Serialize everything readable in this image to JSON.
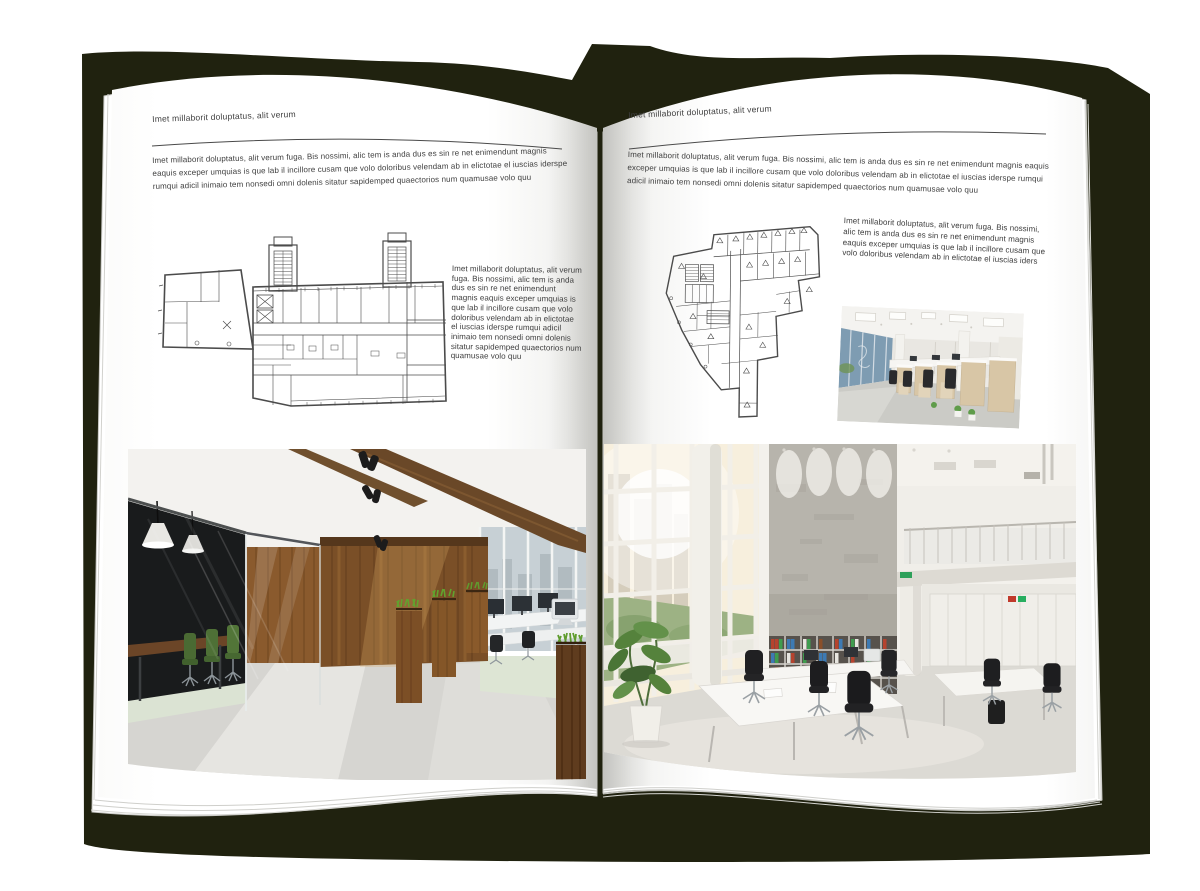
{
  "book": {
    "left_page": {
      "header": "Imet millaborit doluptatus, alit verum",
      "intro": "Imet millaborit doluptatus, alit verum fuga. Bis nossimi, alic tem is anda dus es sin re net enimendunt magnis eaquis exceper umquias is que lab il incillore cusam que volo doloribus velendam ab in elictotae el iuscias iderspe rumqui adicil inimaio tem nonsedi omni dolenis sitatur sapidemped quaectorios num quamusae volo quu",
      "side_text": "Imet millaborit doluptatus, alit verum fuga. Bis nossimi, alic tem is anda dus es sin re net enimendunt magnis eaquis exceper umquias is que lab il incillore cusam que volo doloribus velendam ab in elictotae el iuscias iderspe rumqui adicil inimaio tem nonsedi omni dolenis sitatur sapidemped quaectorios num quamusae volo quu"
    },
    "right_page": {
      "header": "Imet millaborit doluptatus, alit verum",
      "intro": "Imet millaborit doluptatus, alit verum fuga. Bis nossimi, alic tem is anda dus es sin re net enimendunt magnis eaquis exceper umquias is que lab il incillore cusam que volo doloribus velendam ab in elictotae el iuscias iderspe rumqui adicil inimaio tem nonsedi omni dolenis sitatur sapidemped quaectorios num quamusae volo quu",
      "side_text": "Imet millaborit doluptatus, alit verum fuga. Bis nossimi, alic tem is anda dus es sin re net enimendunt magnis eaquis exceper umquias is que lab il incillore cusam que volo doloribus velendam ab in elictotae el iuscias iders"
    },
    "colors": {
      "backdrop_shadow": "#20220f",
      "page": "#ffffff",
      "text": "#3e3e3e",
      "rule": "#4a4a4a",
      "plan_line": "#4b4b4b"
    },
    "illustrations": {
      "left_floor_plan": "building floor plan with stair towers",
      "right_floor_plan": "irregular building floor plan",
      "left_photo": "office with dark glass meeting room, wood wall, planters and desks",
      "right_photo_small": "open plan office with light wood workstations",
      "right_photo_large": "double-height white office with tall windows, shelves and desks"
    }
  }
}
